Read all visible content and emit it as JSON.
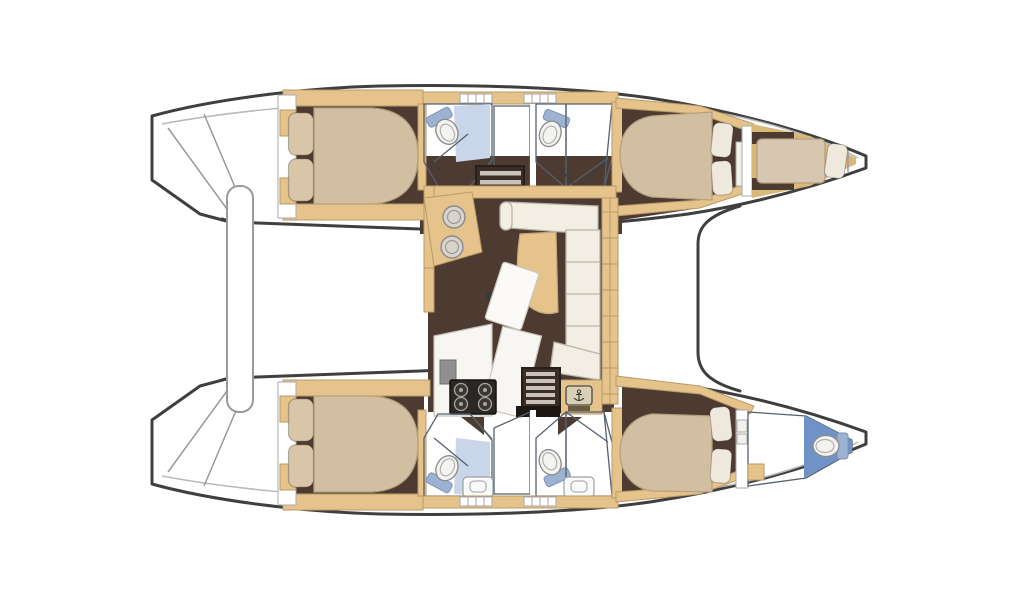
{
  "meta": {
    "label": "catamaran-interior-floor-plan",
    "view": "top-down deck plan"
  },
  "colors": {
    "outline": "#3f3f3f",
    "floor": "#4d3a31",
    "wood": "#e5c38b",
    "woodDeep": "#d9b777",
    "mattress": "#d2bfa1",
    "paleMattress": "#d7c7b0",
    "pillow": "#efe9dd",
    "pillowTan": "#d9c6a8",
    "bathFloor": "#b3c2dd",
    "bathPanel": "#c9d6ea",
    "shower": "#7e9cc9",
    "showerDeep": "#6f93c6",
    "fixtureWhite": "#f4f3f0",
    "fixturePlate": "#9db2d3",
    "sofa": "#f2eee3",
    "tableWhite": "#fbfaf6",
    "counter": "#f7f6f2",
    "stove": "#2b2724",
    "stair": "#3c2d26",
    "tread": "#c9c2ba",
    "gold": "#d9b777",
    "steel": "#d8d4cc",
    "gray": "#8f8f8f",
    "badge": "#d9cfb4",
    "landing": "#1c1713"
  },
  "elements": {
    "icon_names": [
      "toilet-icon",
      "shower-spray-icon",
      "round-sink-icon",
      "stove-burner-icon",
      "helm-badge-icon",
      "pillow",
      "double-bed",
      "single-berth",
      "sofa",
      "dining-table",
      "galley-counter",
      "stairs",
      "wardrobe-grid",
      "crossbeam"
    ]
  }
}
